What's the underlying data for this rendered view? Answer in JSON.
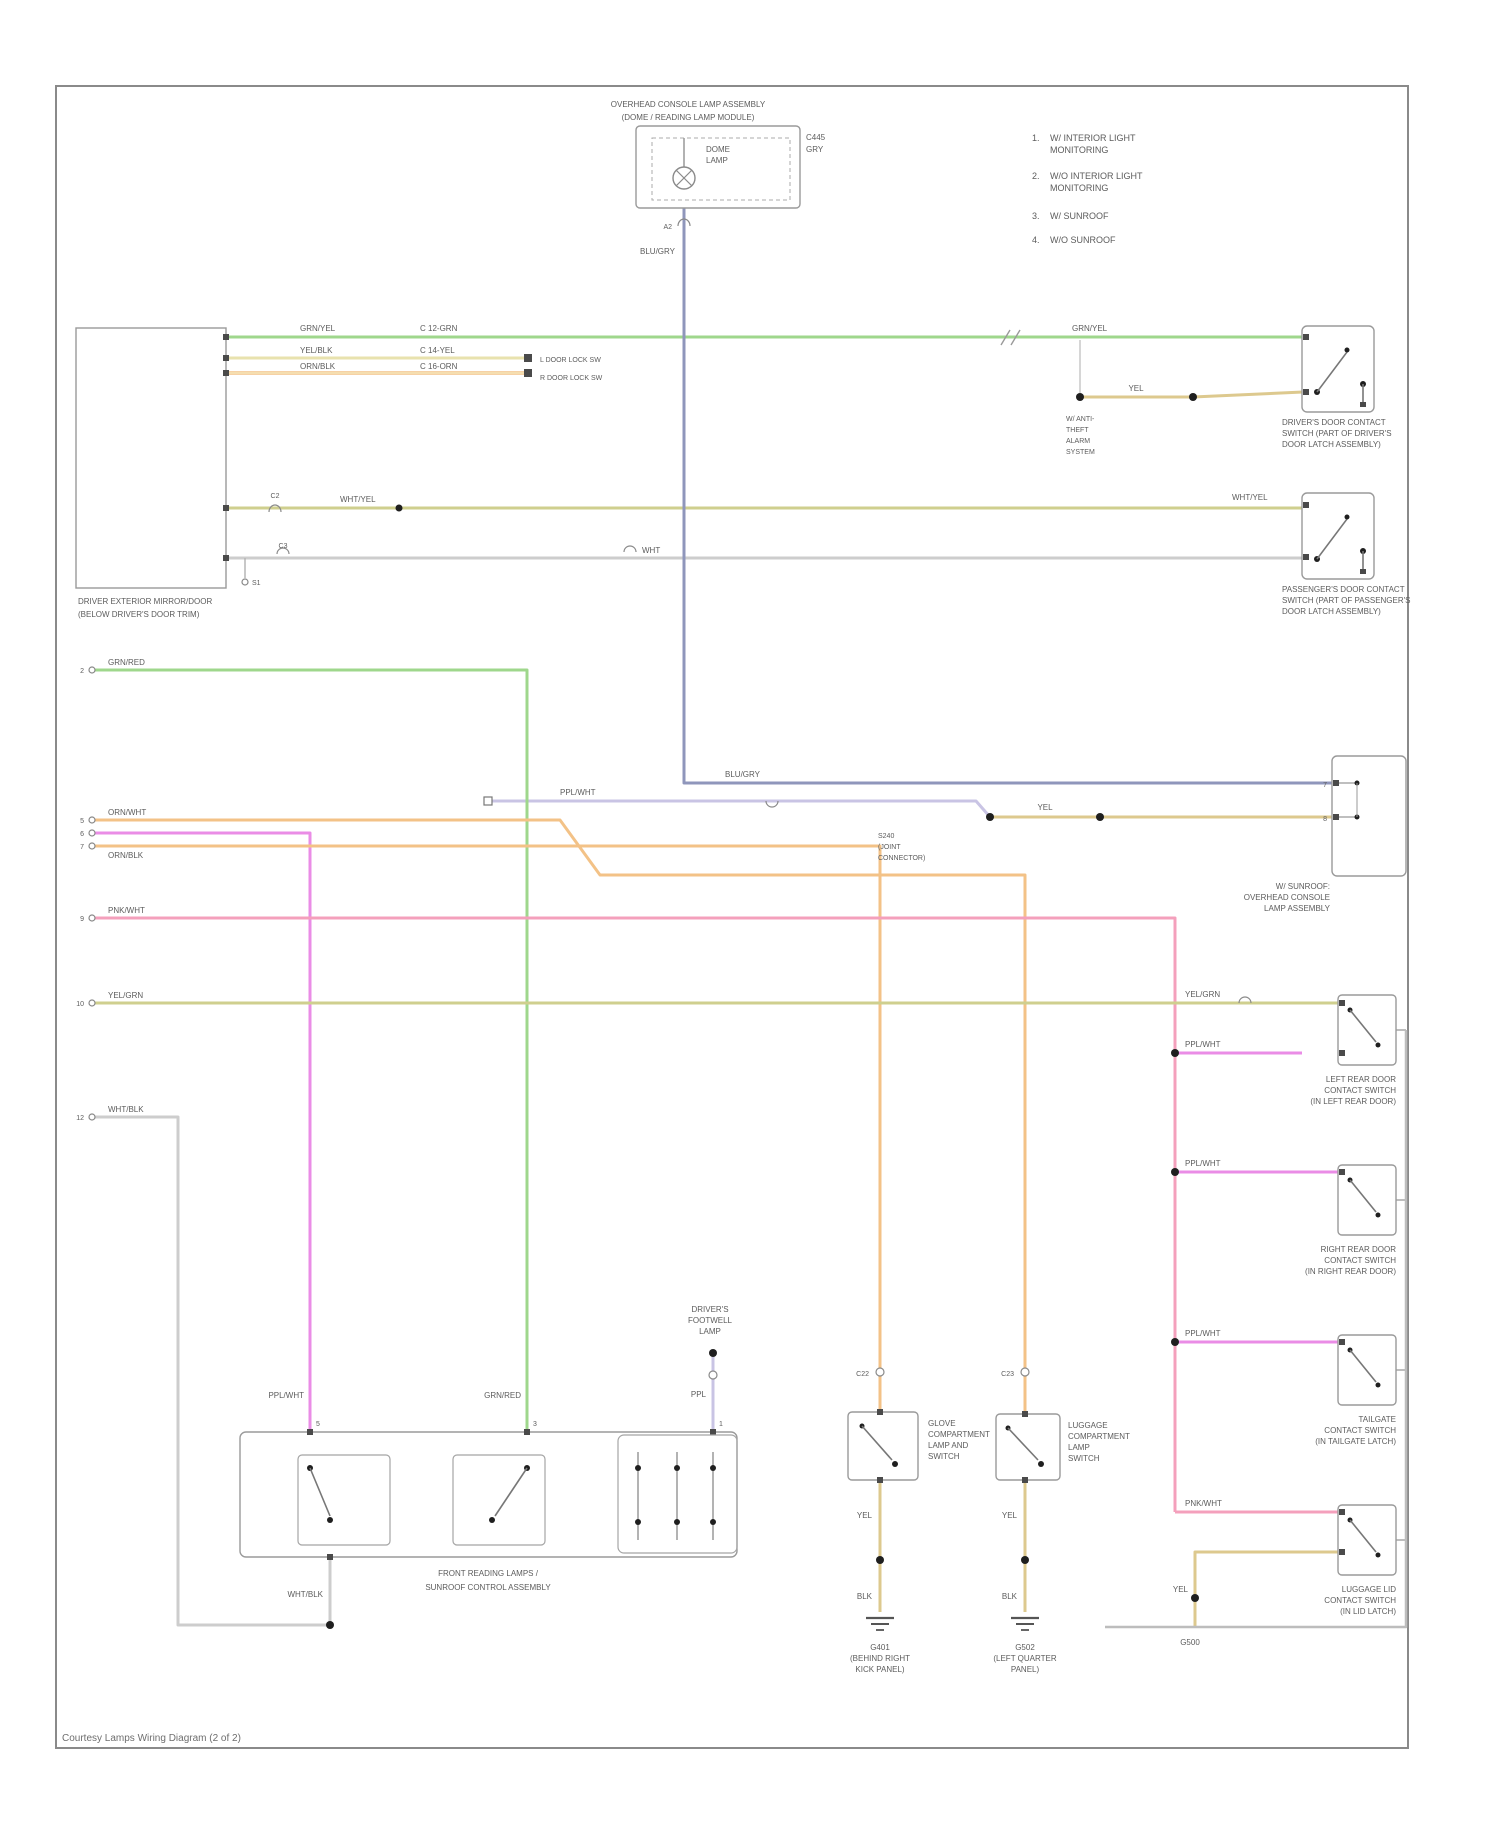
{
  "page": {
    "caption": "Courtesy Lamps Wiring Diagram (2 of 2)"
  },
  "colors": {
    "green": "#9fd78c",
    "yellow": "#e8e2ae",
    "orange": "#f3c287",
    "olive": "#cfcf8e",
    "slate": "#8f96bb",
    "lavender": "#c9c4e4",
    "magenta": "#ea8ce6",
    "pink": "#f4a0bc",
    "tan": "#ddc98e",
    "gray_wire": "#cdcdcd"
  },
  "top_component": {
    "title1": "OVERHEAD CONSOLE LAMP ASSEMBLY",
    "title2": "(DOME / READING LAMP MODULE)",
    "inner1": "DOME",
    "inner2": "LAMP",
    "conn_a": "C445",
    "conn_b": "GRY",
    "pin": "A2",
    "wire": "BLU/GRY"
  },
  "legend": {
    "items": [
      {
        "num": "1.",
        "l1": "W/ INTERIOR LIGHT",
        "l2": "MONITORING"
      },
      {
        "num": "2.",
        "l1": "W/O INTERIOR LIGHT",
        "l2": "MONITORING"
      },
      {
        "num": "3.",
        "l1": "W/ SUNROOF",
        "l2": ""
      },
      {
        "num": "4.",
        "l1": "W/O SUNROOF",
        "l2": ""
      }
    ]
  },
  "left_module": {
    "l1": "DRIVER EXTERIOR MIRROR/DOOR",
    "l2": "(BELOW DRIVER'S DOOR TRIM)",
    "grn": {
      "a": "GRN/YEL",
      "b": "C 12-GRN",
      "c": "GRN/YEL"
    },
    "yel": {
      "a": "YEL/BLK",
      "b": "C 14-YEL",
      "end": "L DOOR LOCK SW"
    },
    "orn": {
      "a": "ORN/BLK",
      "b": "C 16-ORN",
      "end": "R DOOR LOCK SW"
    },
    "olv": {
      "conn": "C2",
      "a": "WHT/YEL",
      "b": "WHT/YEL"
    },
    "wht": {
      "s1": "S1",
      "s2": "C3",
      "a": "WHT"
    }
  },
  "rswitch1": {
    "l1": "DRIVER'S DOOR CONTACT",
    "l2": "SWITCH (PART OF DRIVER'S",
    "l3": "DOOR LATCH ASSEMBLY)",
    "jumper": "YEL",
    "n1": "W/ ANTI-",
    "n2": "THEFT",
    "n3": "ALARM",
    "n4": "SYSTEM"
  },
  "rswitch2": {
    "l1": "PASSENGER'S DOOR CONTACT",
    "l2": "SWITCH (PART OF PASSENGER'S",
    "l3": "DOOR LATCH ASSEMBLY)"
  },
  "middle": {
    "slate": "BLU/GRY",
    "lav": "PPL/WHT",
    "splice": "YEL",
    "s1": "S240",
    "s2": "(JOINT",
    "s3": "CONNECTOR)"
  },
  "right_component": {
    "p1": "7",
    "p2": "8",
    "l1": "W/ SUNROOF:",
    "l2": "OVERHEAD CONSOLE",
    "l3": "LAMP ASSEMBLY"
  },
  "stubs": {
    "grn": {
      "n": "2",
      "l": "GRN/RED"
    },
    "orn1": {
      "n": "5",
      "l": "ORN/WHT"
    },
    "ppl": {
      "n": "6",
      "l": "PPL/WHT"
    },
    "orn2": {
      "n": "7",
      "l": "ORN/BLK"
    },
    "pnk": {
      "n": "9",
      "l": "PNK/WHT"
    },
    "olv": {
      "n": "10",
      "l": "YEL/GRN"
    },
    "gry": {
      "n": "12",
      "l": "WHT/BLK"
    }
  },
  "chain": {
    "h1": "PPL/WHT",
    "h2": "PPL/WHT",
    "h3": "PPL/WHT",
    "h4": "PNK/WHT",
    "olv": "YEL/GRN",
    "tail": "YEL",
    "g": "G500"
  },
  "right_column": [
    {
      "l1": "LEFT REAR DOOR",
      "l2": "CONTACT SWITCH",
      "l3": "(IN LEFT REAR DOOR)"
    },
    {
      "l1": "RIGHT REAR DOOR",
      "l2": "CONTACT SWITCH",
      "l3": "(IN RIGHT REAR DOOR)"
    },
    {
      "l1": "TAILGATE",
      "l2": "CONTACT SWITCH",
      "l3": "(IN TAILGATE LATCH)"
    },
    {
      "l1": "LUGGAGE LID",
      "l2": "CONTACT SWITCH",
      "l3": "(IN LID LATCH)"
    }
  ],
  "verticals": {
    "c22": "C22",
    "c23": "C23",
    "mag": "PPL/WHT",
    "grn": "GRN/RED",
    "ppl": "PPL"
  },
  "switch_a": {
    "l1": "GLOVE",
    "l2": "COMPARTMENT",
    "l3": "LAMP AND",
    "l4": "SWITCH",
    "w1": "YEL",
    "w2": "BLK",
    "g1": "G401",
    "g2": "(BEHIND RIGHT",
    "g3": "KICK PANEL)"
  },
  "switch_b": {
    "l1": "LUGGAGE",
    "l2": "COMPARTMENT",
    "l3": "LAMP",
    "l4": "SWITCH",
    "w1": "YEL",
    "w2": "BLK",
    "g1": "G502",
    "g2": "(LEFT QUARTER",
    "g3": "PANEL)"
  },
  "dome2": {
    "l1": "DRIVER'S",
    "l2": "FOOTWELL",
    "l3": "LAMP"
  },
  "bottom_box": {
    "l1": "FRONT READING LAMPS /",
    "l2": "SUNROOF CONTROL ASSEMBLY",
    "out": "WHT/BLK",
    "p1": "5",
    "p2": "3",
    "p3": "1"
  }
}
